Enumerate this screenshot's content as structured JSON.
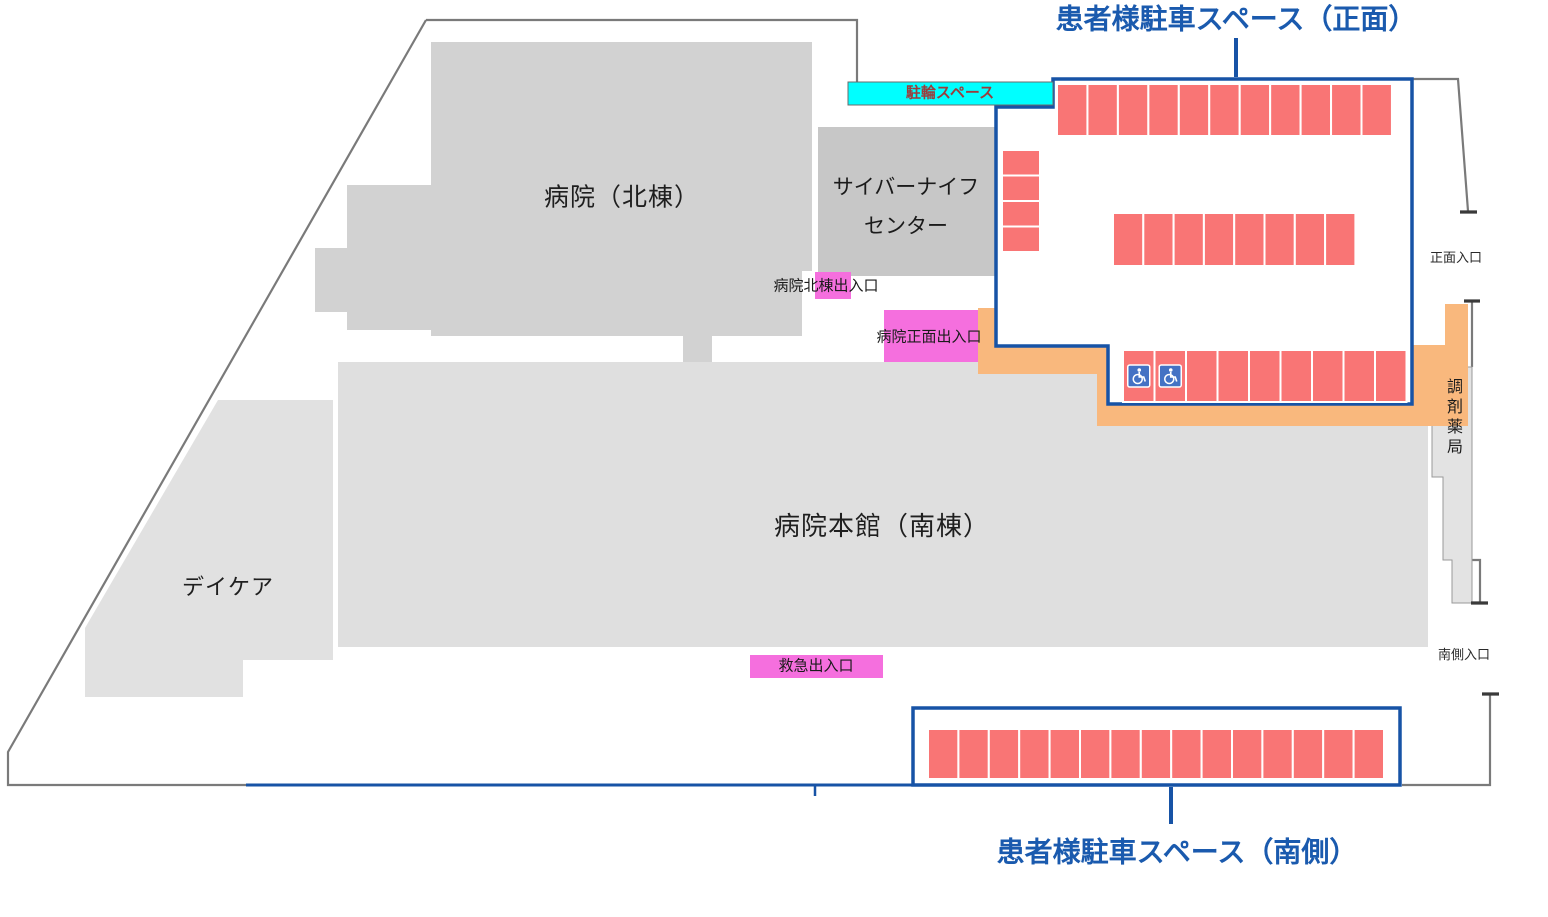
{
  "canvas": {
    "width": 1548,
    "height": 917
  },
  "colors": {
    "navy": "#1753A6",
    "title_text": "#1A5AAE",
    "stall_red": "#F97575",
    "stall_divider": "#FFFFFF",
    "orange_path": "#F9B87D",
    "pink_entrance": "#F56FDE",
    "cyan_bike": "#00FFFF",
    "bike_text": "#9B3D3D",
    "building_gray_north": "#D2D2D2",
    "building_gray_cyber": "#C7C7C7",
    "building_gray_main": "#DFDFDF",
    "building_gray_daycare": "#E1E1E1",
    "building_gray_pharmacy": "#E3E3E3",
    "boundary_gray": "#7A7A7A",
    "handicap_blue": "#4472C4"
  },
  "labels": {
    "bike_area": "駐輪スペース",
    "north_building": "病院（北棟）",
    "cyberknife_center": "サイバーナイフ\nセンター",
    "main_building": "病院本館（南棟）",
    "daycare": "デイケア",
    "pharmacy": "調剤薬局",
    "north_entrance": "病院北棟出入口",
    "front_entrance": "病院正面出入口",
    "emergency_entrance": "救急出入口",
    "front_gate": "正面入口",
    "south_gate": "南側入口"
  },
  "parking": {
    "front": {
      "title": "患者様駐車スペース（正面）",
      "total_stalls": 32,
      "handicap_stalls": 2
    },
    "south": {
      "title": "患者様駐車スペース（南側）",
      "total_stalls": 15
    },
    "rows": [
      {
        "name": "front-top-row",
        "area": "front",
        "x": 1057,
        "y": 84,
        "stall_w": 30.45,
        "stall_h": 52,
        "count": 11,
        "direction": "h"
      },
      {
        "name": "front-left-column",
        "area": "front",
        "x": 1002,
        "y": 150,
        "stall_w": 38,
        "stall_h": 25.5,
        "count": 4,
        "direction": "v"
      },
      {
        "name": "front-middle-row",
        "area": "front",
        "x": 1113,
        "y": 213,
        "stall_w": 30.3,
        "stall_h": 53,
        "count": 8,
        "direction": "h"
      },
      {
        "name": "front-bottom-row",
        "area": "front",
        "x": 1123,
        "y": 350,
        "stall_w": 31.5,
        "stall_h": 52,
        "count": 9,
        "direction": "h",
        "handicap": [
          0,
          1
        ]
      },
      {
        "name": "south-row",
        "area": "south",
        "x": 928,
        "y": 729,
        "stall_w": 30.4,
        "stall_h": 50,
        "count": 15,
        "direction": "h"
      }
    ]
  }
}
